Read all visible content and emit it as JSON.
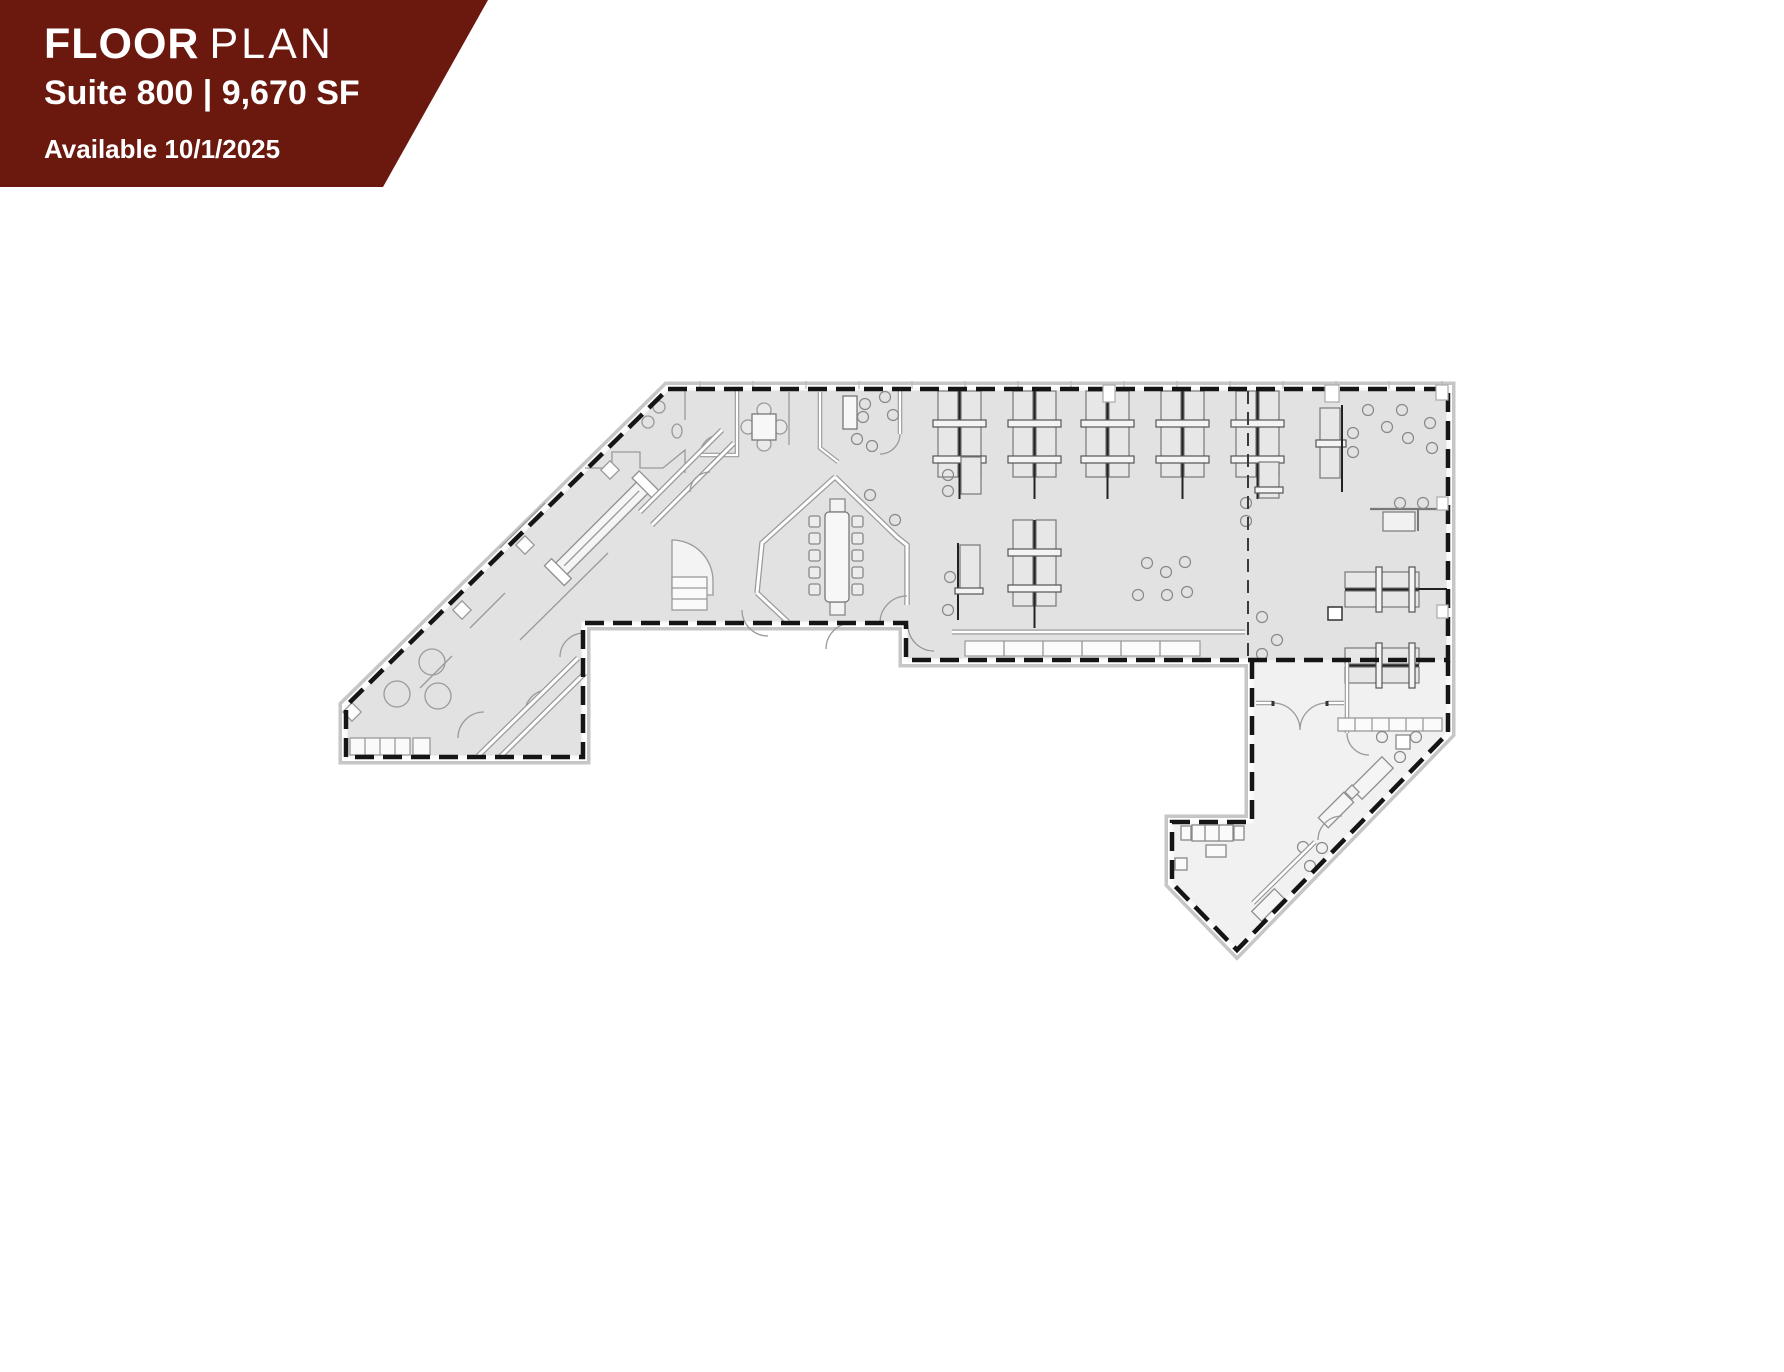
{
  "banner": {
    "title_primary": "FLOOR",
    "title_secondary": "PLAN",
    "suite_line": "Suite 800 | 9,670 SF",
    "availability": "Available 10/1/2025",
    "background": "#6B180F",
    "text_color": "#FFFFFF"
  },
  "floor_plan": {
    "suite_fill": "#E2E2E2",
    "annex_fill": "#F1F1F1",
    "boundary_color": "#151515",
    "wall_casing": "#C6C6C6",
    "furniture_line": "#8F8F8F"
  }
}
